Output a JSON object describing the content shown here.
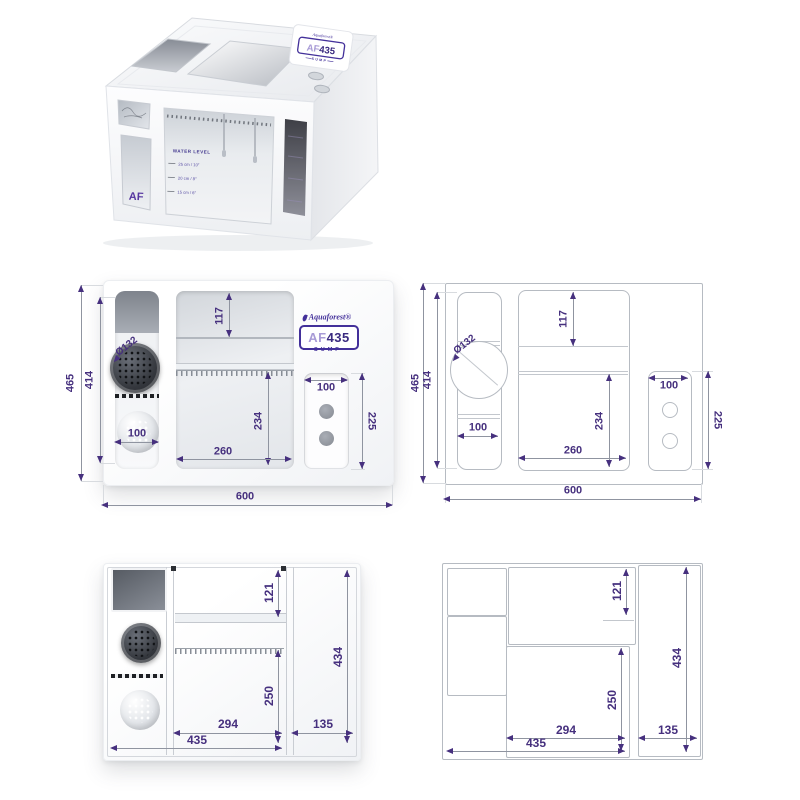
{
  "brand": {
    "name": "Aquaforest®",
    "model_prefix": "AF",
    "model_number": "435",
    "model_series": "SUMP",
    "side_monogram": "AF"
  },
  "render3d": {
    "water_level_title": "WATER LEVEL",
    "water_levels": [
      "25 cm / 10″",
      "20 cm / 8″",
      "15 cm / 6″"
    ]
  },
  "front_view": {
    "dims": {
      "outer_height": "465",
      "inner_height": "414",
      "sock_diameter": "Ø132",
      "sock_chamber_width": "100",
      "drip_tray_height": "117",
      "main_chamber_height": "234",
      "main_chamber_width": "260",
      "pump_recess_width": "100",
      "pump_recess_height": "225",
      "total_width": "600"
    }
  },
  "top_view": {
    "dims": {
      "shelf_depth": "121",
      "main_chamber_depth": "250",
      "main_chamber_width": "294",
      "left_section_width": "435",
      "return_section_width": "135",
      "inner_depth": "434"
    }
  },
  "colors": {
    "dimension_accent": "#46307e",
    "brand_purple": "#43309a"
  }
}
